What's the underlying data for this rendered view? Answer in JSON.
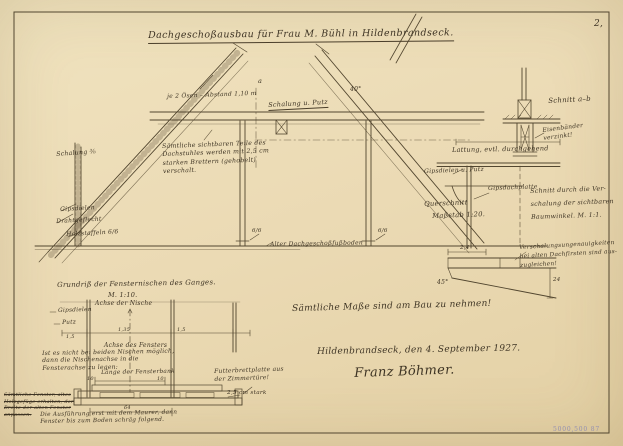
{
  "sheet": {
    "page_number": "2,",
    "corner_stamp": "5000,500 87"
  },
  "title": {
    "text": "Dachgeschoßausbau für Frau M. Bühl in Hildenbrandseck."
  },
  "section": {
    "oesen_dim": "je 2 Ösen – Abstand 1,10 m",
    "marker_a": "a",
    "schalung_putz": "Schalung u. Putz",
    "angle_right": "40°",
    "schalung_left": "Schalung ⅜",
    "boards_note": "Sämtliche sichtbaren Teile des\nDachstuhles werden mit 2,5 cm\nstarken Brettern (gehobelt)\nverschalt.",
    "gipsdielen": "Gipsdielen",
    "drahtgeflecht": "Drahtgeflecht",
    "holzstaffeln": "Holzstaffeln 6/6",
    "post_left_dim": "6/6",
    "post_right_dim": "6/6",
    "floor_label": "Alter Dachgeschoßfußboden"
  },
  "details": {
    "schnitt_ab_title": "Schnitt a–b",
    "eisen_note": "Eisenbänder\n verzinkt!",
    "lattung": "Lattung, evtl. durchgehend",
    "gips_putz": "Gipsdielen u. Putz",
    "gipsdachplatte": "Gipsdachplatte",
    "querschnitt": "Querschnitt",
    "querschnitt_scale": "Maßstab 1:20.",
    "tram_note": "Schnitt durch die Ver-\nschalung der sichtbaren\nBaumwinkel. M. 1:1.",
    "dim_2_4": "2,4",
    "angle_45": "45°",
    "dim_24": "24",
    "first_note": "Verschalungsungenauigkeiten\nbei alten Dachfirsten sind aus-\nzugleichen!"
  },
  "plan": {
    "title": "Grundriß der Fensternischen des Ganges.",
    "scale": "M. 1:10.",
    "axis_niche": "Achse der Nische",
    "gipsdielen": "Gipsdielen",
    "putz": "Putz",
    "dim_left": "1,5",
    "dim_center": "1,35",
    "dim_right": "1,5",
    "axis_window": "Achse des Fensters",
    "niche_note": "Ist es nicht bei beiden Nischen möglich,\ndann die Nischenachse in die\nFensterachse zu legen:",
    "sill_length": "Länge der Fensterbank",
    "dim_10_left": "10",
    "dim_10_right": "10",
    "dim_64": "64",
    "futter_note": "Futterbrettplatte aus\n der Zimmertüre!",
    "thickness": "2,5 cm stark",
    "struck_note": "Sämtliche Fenster, altes\nHolzgefüge erhalten, der\nBreite der alten Fenster\nanpassen.",
    "exec_note": "Die Ausführung erst mit dem Maurer, dann\nFenster bis zum Boden schräg folgend."
  },
  "footer": {
    "measure_note": "Sämtliche Maße sind am Bau zu nehmen!",
    "place_date": "Hildenbrandseck, den 4. September 1927.",
    "signature": "Franz Böhmer."
  }
}
